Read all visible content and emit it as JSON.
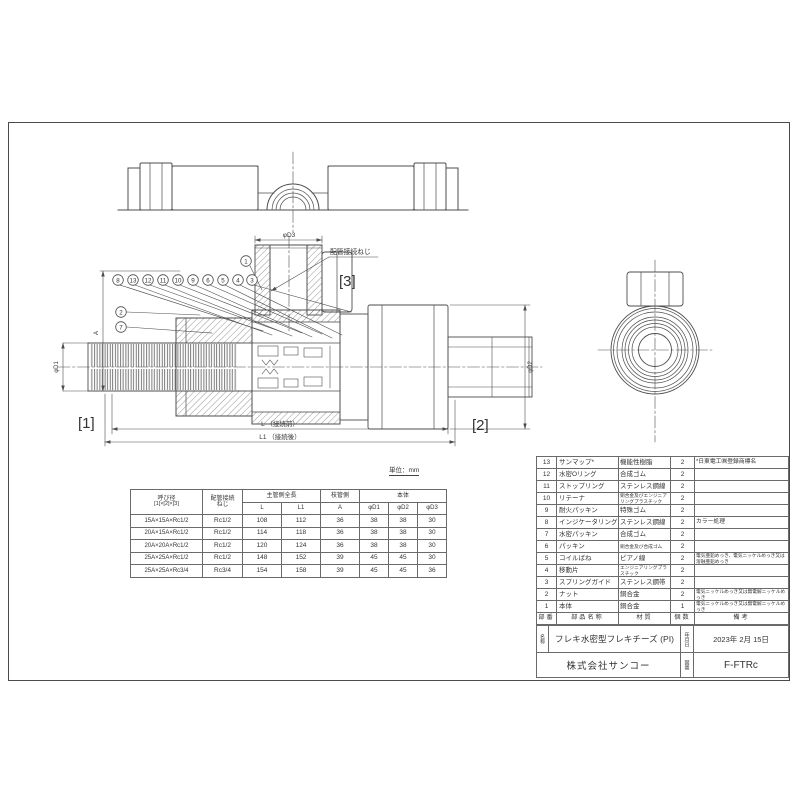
{
  "meta": {
    "unit_label": "単位：mm"
  },
  "colors": {
    "line": "#4d4d4d",
    "hatch": "#6a6a6a",
    "text": "#333333",
    "background": "#ffffff"
  },
  "drawing": {
    "labels": {
      "connector1": "[1]",
      "connector2": "[2]",
      "connector3": "[3]",
      "pipe_thread": "配管接続ねじ",
      "dim_d1": "φD1",
      "dim_d2": "φD2",
      "dim_d3": "φD3",
      "dim_a": "A",
      "dim_l": "L （接続前）",
      "dim_l1": "L1 （接続後）"
    },
    "callouts": {
      "c1": "1",
      "c2": "2",
      "c3": "3",
      "c4": "4",
      "c5": "5",
      "c6": "6",
      "c7": "7",
      "c8": "8",
      "c9": "9",
      "c10": "10",
      "c11": "11",
      "c12": "12",
      "c13": "13"
    }
  },
  "dimension_table": {
    "header": {
      "col1_line1": "呼び径",
      "col1_line2": "[1]×[2]×[3]",
      "col2_line1": "配管接続",
      "col2_line2": "ねじ",
      "group_main": "主管側全長",
      "group_branch": "枝管側",
      "group_body": "本体",
      "sub": [
        "L",
        "L1",
        "A",
        "φD1",
        "φD2",
        "φD3"
      ]
    },
    "rows": [
      [
        "15A×15A×Rc1/2",
        "Rc1/2",
        "108",
        "112",
        "36",
        "38",
        "38",
        "30"
      ],
      [
        "20A×15A×Rc1/2",
        "Rc1/2",
        "114",
        "118",
        "36",
        "38",
        "38",
        "30"
      ],
      [
        "20A×20A×Rc1/2",
        "Rc1/2",
        "120",
        "124",
        "36",
        "38",
        "38",
        "30"
      ],
      [
        "25A×25A×Rc1/2",
        "Rc1/2",
        "148",
        "152",
        "39",
        "45",
        "45",
        "30"
      ],
      [
        "25A×25A×Rc3/4",
        "Rc3/4",
        "154",
        "158",
        "39",
        "45",
        "45",
        "36"
      ]
    ]
  },
  "parts_table": {
    "rows": [
      [
        "13",
        "サンマップ*",
        "機能性樹脂",
        "2",
        "*日東電工㈱登録商標名"
      ],
      [
        "12",
        "水密Oリング",
        "合成ゴム",
        "2",
        ""
      ],
      [
        "11",
        "ストップリング",
        "ステンレス鋼線",
        "2",
        ""
      ],
      [
        "10",
        "リテーナ",
        "銅合金及びエンジニアリングプラスチック",
        "2",
        ""
      ],
      [
        "9",
        "耐火パッキン",
        "特殊ゴム",
        "2",
        ""
      ],
      [
        "8",
        "インジケータリング",
        "ステンレス鋼線",
        "2",
        "カラー処理"
      ],
      [
        "7",
        "水密パッキン",
        "合成ゴム",
        "2",
        ""
      ],
      [
        "6",
        "パッキン",
        "銅合金及び合成ゴム",
        "2",
        ""
      ],
      [
        "5",
        "コイルばね",
        "ピアノ線",
        "2",
        "電気亜鉛めっき、電気ニッケルめっき又は溶融亜鉛めっき"
      ],
      [
        "4",
        "移動片",
        "エンジニアリングプラスチック",
        "2",
        ""
      ],
      [
        "3",
        "スプリングガイド",
        "ステンレス鋼帯",
        "2",
        ""
      ],
      [
        "2",
        "ナット",
        "銅合金",
        "2",
        "電気ニッケルめっき又は無電解ニッケルめっき"
      ],
      [
        "1",
        "本体",
        "銅合金",
        "1",
        "電気ニッケルめっき又は無電解ニッケルめっき"
      ]
    ],
    "footer": [
      "部番",
      "部品名称",
      "材質",
      "個数",
      "備考"
    ]
  },
  "title_block": {
    "name_label": "名称",
    "name_value": "フレキ水密型フレキチーズ (PI)",
    "date_label": "年月日",
    "date_value": "2023年 2月 15日",
    "company": "株式会社サンコー",
    "dwg_no_label": "図番",
    "dwg_no_value": "F-FTRc"
  }
}
